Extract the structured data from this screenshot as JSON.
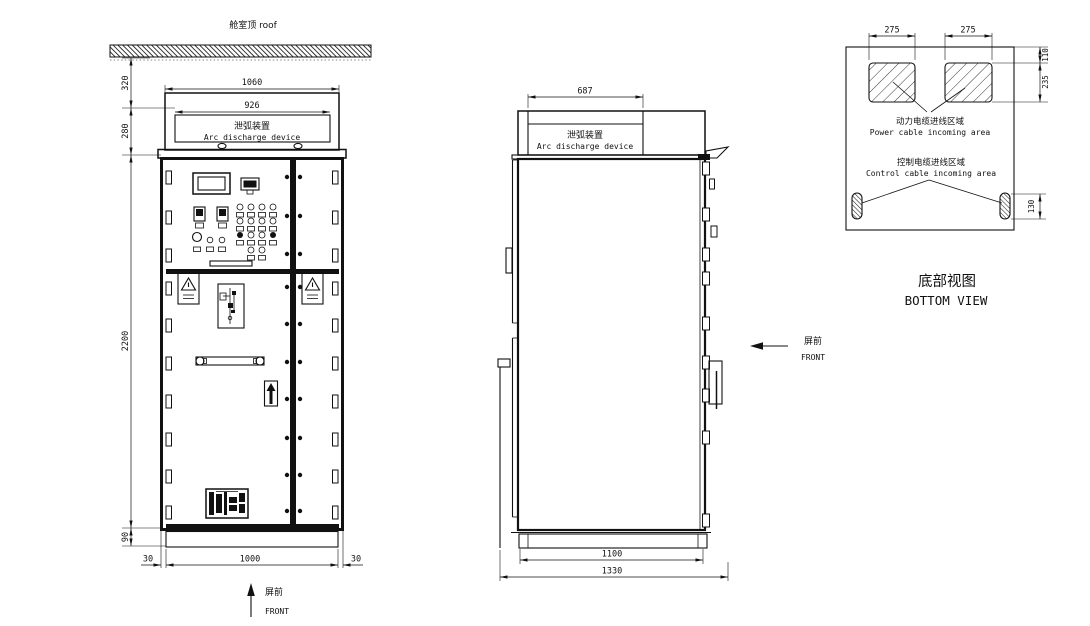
{
  "front_view": {
    "roof_label": "舱室顶 roof",
    "arc_device": {
      "cn": "泄弧装置",
      "en": "Arc discharge device"
    },
    "dims": {
      "roof_offset": "320",
      "arc_height": "280",
      "body_height": "2200",
      "base_height": "90",
      "overall_width": "1060",
      "arc_inner_width": "926",
      "left_foot": "30",
      "body_width": "1000",
      "right_foot": "30"
    },
    "front_marker": {
      "cn": "屏前",
      "en": "FRONT"
    }
  },
  "side_view": {
    "arc_device": {
      "cn": "泄弧装置",
      "en": "Arc discharge device"
    },
    "dims": {
      "arc_depth": "687",
      "base_depth": "1100",
      "overall_depth": "1330"
    },
    "front_marker": {
      "cn": "屏前",
      "en": "FRONT"
    }
  },
  "bottom_view": {
    "title": {
      "cn": "底部视图",
      "en": "BOTTOM VIEW"
    },
    "power_cable_area": {
      "cn": "动力电缆进线区域",
      "en": "Power cable incoming area"
    },
    "control_cable_area": {
      "cn": "控制电缆进线区域",
      "en": "Control cable incoming area"
    },
    "dims": {
      "power_cutout_left": "275",
      "power_cutout_right": "275",
      "top_offset": "110",
      "cutout_depth": "235",
      "slot_length": "130"
    }
  }
}
